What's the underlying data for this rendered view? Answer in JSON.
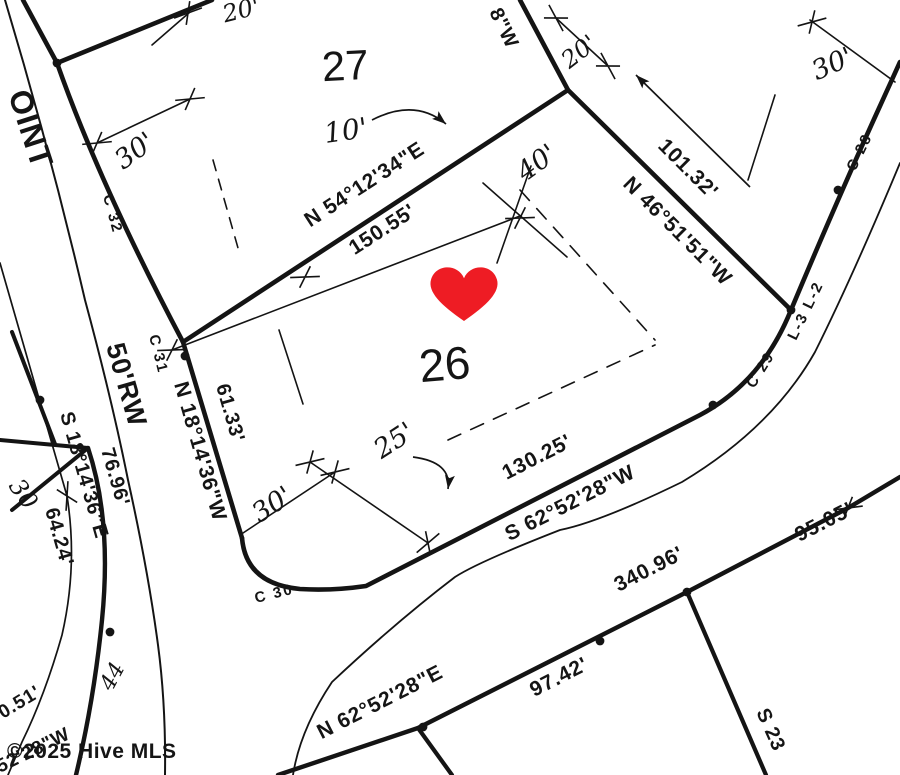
{
  "map": {
    "ink": "#141414",
    "background": "#ffffff",
    "watermark": {
      "text": "©2025 Hive MLS",
      "x": 7,
      "y": 758,
      "size": 21,
      "color": "rgba(128,128,128,0.85)"
    },
    "heart": {
      "x": 464,
      "y": 288,
      "scale": 1.22,
      "color": "#ee1c24"
    },
    "lot_numbers": {
      "lot26": "26",
      "lot27": "27"
    },
    "labels": [
      {
        "id": "street-name-partial",
        "text": "OINT",
        "x": 8,
        "y": 94,
        "rot": 72,
        "size": 32,
        "cls": "rw"
      },
      {
        "id": "curve-c32",
        "text": "C 32",
        "x": 103,
        "y": 196,
        "rot": 75,
        "size": 15,
        "cls": "small"
      },
      {
        "id": "curve-c31",
        "text": "C 31",
        "x": 149,
        "y": 336,
        "rot": 76,
        "size": 15,
        "cls": "small"
      },
      {
        "id": "bearing-lot26-west",
        "text": "N 18°14'36\"W",
        "x": 174,
        "y": 384,
        "rot": 74,
        "size": 21,
        "cls": "survey"
      },
      {
        "id": "dist-lot26-west",
        "text": "61.33'",
        "x": 216,
        "y": 386,
        "rot": 74,
        "size": 20,
        "cls": "survey"
      },
      {
        "id": "rw-width",
        "text": "50'RW",
        "x": 106,
        "y": 346,
        "rot": 74,
        "size": 27,
        "cls": "rw"
      },
      {
        "id": "bearing-road-cl",
        "text": "S 18°14'36\"E",
        "x": 60,
        "y": 414,
        "rot": 74,
        "size": 20,
        "cls": "survey"
      },
      {
        "id": "dist-7696",
        "text": "76.96'",
        "x": 101,
        "y": 450,
        "rot": 74,
        "size": 20,
        "cls": "survey"
      },
      {
        "id": "dist-6424",
        "text": "64.24'",
        "x": 45,
        "y": 510,
        "rot": 74,
        "size": 20,
        "cls": "survey"
      },
      {
        "id": "hand-30-left",
        "text": "30",
        "x": 8,
        "y": 486,
        "rot": 55,
        "size": 24,
        "cls": "hand"
      },
      {
        "id": "bearing-division",
        "text": "N 54°12'34\"E",
        "x": 368,
        "y": 190,
        "rot": -33,
        "size": 21,
        "cls": "survey",
        "anchor": "middle"
      },
      {
        "id": "dist-division",
        "text": "150.55'",
        "x": 386,
        "y": 235,
        "rot": -33,
        "size": 21,
        "cls": "survey",
        "anchor": "middle"
      },
      {
        "id": "bearing-top-partial",
        "text": "8\"W",
        "x": 489,
        "y": 12,
        "rot": 64,
        "size": 20,
        "cls": "survey"
      },
      {
        "id": "hand-20-top",
        "text": "20'",
        "x": 243,
        "y": 18,
        "rot": -14,
        "size": 24,
        "cls": "hand",
        "anchor": "middle"
      },
      {
        "id": "hand-30-lot27",
        "text": "30'",
        "x": 140,
        "y": 158,
        "rot": -36,
        "size": 27,
        "cls": "hand",
        "anchor": "middle"
      },
      {
        "id": "hand-10-lot27",
        "text": "10'",
        "x": 347,
        "y": 140,
        "rot": -8,
        "size": 28,
        "cls": "hand",
        "anchor": "middle"
      },
      {
        "id": "hand-20-ne",
        "text": "20'",
        "x": 584,
        "y": 58,
        "rot": -38,
        "size": 24,
        "cls": "hand",
        "anchor": "middle"
      },
      {
        "id": "hand-40",
        "text": "40'",
        "x": 542,
        "y": 170,
        "rot": -36,
        "size": 27,
        "cls": "hand",
        "anchor": "middle"
      },
      {
        "id": "bearing-lot26-ne",
        "text": "N 46°51'51\"W",
        "x": 622,
        "y": 185,
        "rot": 45,
        "size": 21,
        "cls": "survey"
      },
      {
        "id": "dist-lot26-ne",
        "text": "101.32'",
        "x": 657,
        "y": 147,
        "rot": 45,
        "size": 21,
        "cls": "survey"
      },
      {
        "id": "hand-30-topright",
        "text": "30'",
        "x": 836,
        "y": 72,
        "rot": -24,
        "size": 27,
        "cls": "hand",
        "anchor": "middle"
      },
      {
        "id": "curve-c28",
        "text": "C 28",
        "x": 855,
        "y": 172,
        "rot": -64,
        "size": 15,
        "cls": "small"
      },
      {
        "id": "line-l3-l2",
        "text": "L-3 L-2",
        "x": 796,
        "y": 341,
        "rot": -64,
        "size": 15,
        "cls": "small"
      },
      {
        "id": "curve-c29",
        "text": "C 29",
        "x": 754,
        "y": 389,
        "rot": -58,
        "size": 15,
        "cls": "small"
      },
      {
        "id": "lot-number-26",
        "text": "26",
        "x": 446,
        "y": 380,
        "rot": -5,
        "size": 46,
        "cls": "big",
        "anchor": "middle"
      },
      {
        "id": "lot-number-27",
        "text": "27",
        "x": 346,
        "y": 80,
        "rot": -3,
        "size": 42,
        "cls": "big",
        "anchor": "middle"
      },
      {
        "id": "hand-25",
        "text": "25'",
        "x": 399,
        "y": 448,
        "rot": -33,
        "size": 27,
        "cls": "hand",
        "anchor": "middle"
      },
      {
        "id": "hand-30-front",
        "text": "30'",
        "x": 277,
        "y": 512,
        "rot": -33,
        "size": 27,
        "cls": "hand",
        "anchor": "middle"
      },
      {
        "id": "dist-lot26-front",
        "text": "130.25'",
        "x": 540,
        "y": 463,
        "rot": -27,
        "size": 21,
        "cls": "survey",
        "anchor": "middle"
      },
      {
        "id": "bearing-lot26-front",
        "text": "S 62°52'28\"W",
        "x": 573,
        "y": 509,
        "rot": -27,
        "size": 21,
        "cls": "survey",
        "anchor": "middle"
      },
      {
        "id": "curve-c30",
        "text": "C 30",
        "x": 256,
        "y": 603,
        "rot": -14,
        "size": 15,
        "cls": "small"
      },
      {
        "id": "dist-road-340",
        "text": "340.96'",
        "x": 652,
        "y": 575,
        "rot": -27,
        "size": 21,
        "cls": "survey",
        "anchor": "middle"
      },
      {
        "id": "dist-road-95",
        "text": "95.05'",
        "x": 827,
        "y": 528,
        "rot": -27,
        "size": 21,
        "cls": "survey",
        "anchor": "middle"
      },
      {
        "id": "bearing-road-bottom",
        "text": "N 62°52'28\"E",
        "x": 383,
        "y": 708,
        "rot": -27,
        "size": 21,
        "cls": "survey",
        "anchor": "middle"
      },
      {
        "id": "dist-road-9742",
        "text": "97.42'",
        "x": 562,
        "y": 683,
        "rot": -27,
        "size": 21,
        "cls": "survey",
        "anchor": "middle"
      },
      {
        "id": "bearing-se-partial",
        "text": "S 23",
        "x": 756,
        "y": 712,
        "rot": 66,
        "size": 20,
        "cls": "survey"
      },
      {
        "id": "hand-44",
        "text": "44",
        "x": 112,
        "y": 692,
        "rot": -62,
        "size": 22,
        "cls": "hand"
      },
      {
        "id": "dist-partial-051",
        "text": "0.51'",
        "x": 3,
        "y": 719,
        "rot": -31,
        "size": 19,
        "cls": "survey"
      },
      {
        "id": "bearing-partial-5228",
        "text": "52'28\"W",
        "x": 0,
        "y": 773,
        "rot": -26,
        "size": 19,
        "cls": "survey"
      }
    ],
    "lines": [
      {
        "id": "road-edge-east-upper",
        "d": "M23,0 L57,63 Q100,185 183,342",
        "w": 4.6
      },
      {
        "id": "lot26-west-line",
        "d": "M183,342 L242,538",
        "w": 4.6
      },
      {
        "id": "lot26-front-and-road",
        "d": "M242,538 Q246,584 300,589 Q332,591 366,586 L700,415 Q762,382 791,310 Q838,198 880,106 L900,62",
        "w": 4.6
      },
      {
        "id": "lot-division-line",
        "d": "M183,342 L568,90",
        "w": 4.6
      },
      {
        "id": "lot27-east-line",
        "d": "M568,90 L520,0",
        "w": 4.6
      },
      {
        "id": "lot26-ne-line",
        "d": "M568,90 L791,310",
        "w": 4.6
      },
      {
        "id": "lot27-rear-branch",
        "d": "M57,63 L212,0",
        "w": 4.6
      },
      {
        "id": "road-south-edge",
        "d": "M278,775 L418,728 L687,592 L848,508 L900,477",
        "w": 4.4
      },
      {
        "id": "lot-line-drop",
        "d": "M418,728 L452,775",
        "w": 4.2
      },
      {
        "id": "lot-line-se",
        "d": "M687,592 L766,775",
        "w": 4.2
      },
      {
        "id": "across-lot-horizontal",
        "d": "M0,440 L88,448",
        "w": 4
      },
      {
        "id": "across-lot-diagonal",
        "d": "M12,510 L88,448",
        "w": 4
      },
      {
        "id": "across-lot-vertical",
        "d": "M12,332 L55,444",
        "w": 4
      },
      {
        "id": "road-west-curve",
        "d": "M88,448 Q112,520 102,620 Q94,700 76,775",
        "w": 4.4
      },
      {
        "id": "road-west-rw-edge",
        "d": "M5,0 Q50,150 85,300 Q112,400 128,480 Q148,570 158,645 Q166,705 165,775",
        "w": 2
      },
      {
        "id": "road-centerline",
        "d": "M0,263 L67,496 Q78,565 62,635 Q45,695 22,742 L8,775",
        "w": 1.7
      },
      {
        "id": "road-east-rw-edge",
        "d": "M900,163 Q852,278 815,352 Q772,428 682,482 Q600,522 560,530 Q478,562 455,577 Q396,622 332,682 Q300,730 293,775",
        "w": 1.8
      },
      {
        "id": "dim-line-15055",
        "d": "M172,350 L520,216",
        "w": 1.6
      },
      {
        "id": "dim-line-40a",
        "d": "M483,183 L567,257",
        "w": 1.6
      },
      {
        "id": "dim-line-40b",
        "d": "M531,166 L497,263",
        "w": 1.6
      },
      {
        "id": "dim-line-20ne",
        "d": "M556,18 L608,66",
        "w": 1.6
      },
      {
        "id": "dim-line-20top",
        "d": "M152,45 L190,12",
        "w": 1.6
      },
      {
        "id": "dim-line-30-lot27",
        "d": "M97,143 L190,99",
        "w": 1.6
      },
      {
        "id": "setback-dash-lot27",
        "d": "M213,160 L240,255",
        "w": 1.6,
        "dash": "11,9"
      },
      {
        "id": "setback-dash-26-ne",
        "d": "M520,190 L655,340",
        "w": 1.6,
        "dash": "14,11"
      },
      {
        "id": "setback-dash-26-south",
        "d": "M448,440 L655,345",
        "w": 1.6,
        "dash": "14,11"
      },
      {
        "id": "setback-seg-26-west",
        "d": "M279,330 L303,404",
        "w": 1.6
      },
      {
        "id": "dim-line-25",
        "d": "M310,462 L428,543",
        "w": 1.6
      },
      {
        "id": "dim-line-30-front",
        "d": "M240,535 L335,472",
        "w": 1.6
      },
      {
        "id": "road-ne-short-line",
        "d": "M775,95 L748,180",
        "w": 1.6
      },
      {
        "id": "dim-line-30-topright",
        "d": "M810,20 L895,82",
        "w": 1.6
      }
    ],
    "arrows": [
      {
        "id": "arrow-ne-road",
        "d": "M750,187 L636,75",
        "hx": 636,
        "hy": 75,
        "hrot": -135
      },
      {
        "id": "arrow-10-lot27",
        "d": "M372,120 Q415,98 446,124",
        "hx": 446,
        "hy": 124,
        "hrot": 40
      },
      {
        "id": "arrow-25-lot26",
        "d": "M413,457 Q452,462 448,489",
        "hx": 448,
        "hy": 489,
        "hrot": 98
      }
    ],
    "ticks": [
      {
        "x": 172,
        "y": 350,
        "rot": -22
      },
      {
        "x": 305,
        "y": 277,
        "rot": -22
      },
      {
        "x": 520,
        "y": 218,
        "rot": -22
      },
      {
        "x": 556,
        "y": 18,
        "rot": 42
      },
      {
        "x": 608,
        "y": 66,
        "rot": 42
      },
      {
        "x": 97,
        "y": 143,
        "rot": -25
      },
      {
        "x": 190,
        "y": 99,
        "rot": -25
      },
      {
        "x": 188,
        "y": 13,
        "rot": -40
      },
      {
        "x": 310,
        "y": 462,
        "rot": -33
      },
      {
        "x": 428,
        "y": 543,
        "rot": -60
      },
      {
        "x": 335,
        "y": 472,
        "rot": -33
      },
      {
        "x": 848,
        "y": 508,
        "rot": -27
      },
      {
        "x": 67,
        "y": 496,
        "rot": 74
      },
      {
        "x": 812,
        "y": 22,
        "rot": -35
      }
    ],
    "dots": [
      {
        "x": 57,
        "y": 63
      },
      {
        "x": 185,
        "y": 356
      },
      {
        "x": 110,
        "y": 632
      },
      {
        "x": 713,
        "y": 405
      },
      {
        "x": 791,
        "y": 310
      },
      {
        "x": 838,
        "y": 190
      },
      {
        "x": 687,
        "y": 592
      },
      {
        "x": 423,
        "y": 727
      },
      {
        "x": 600,
        "y": 641
      },
      {
        "x": 40,
        "y": 400
      }
    ]
  }
}
